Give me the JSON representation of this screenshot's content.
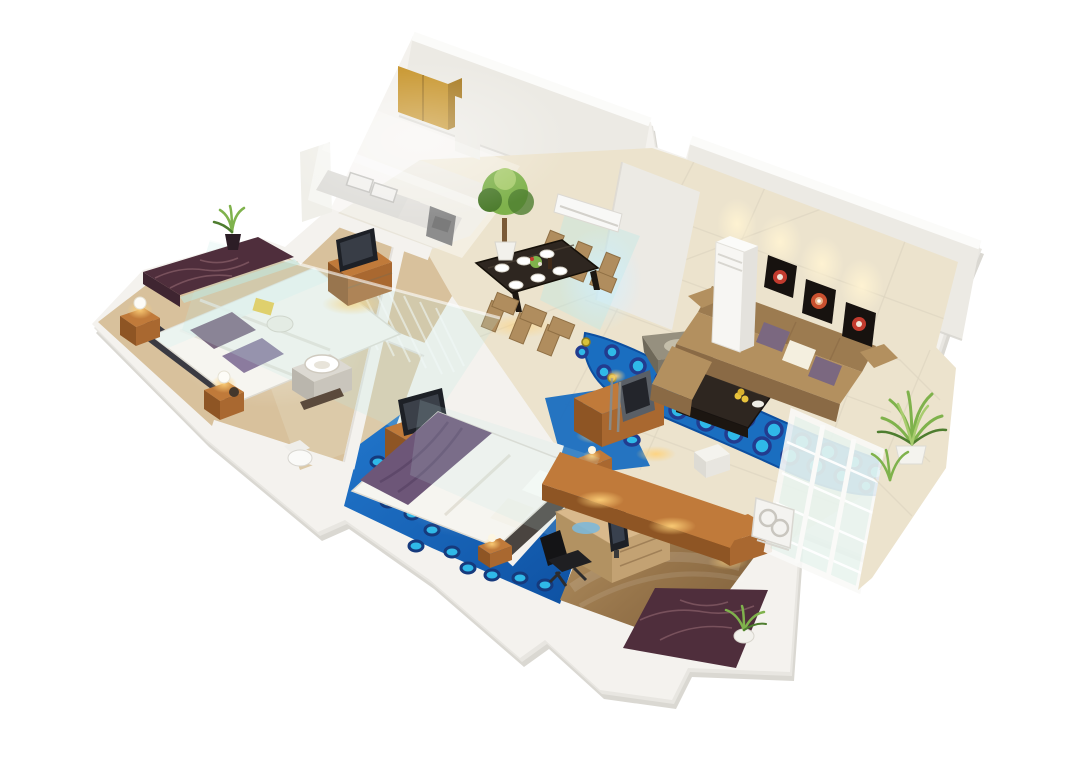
{
  "meta": {
    "title": "3D isometric apartment floor plan render",
    "style": "photoreal dollhouse cutaway, white background, no visible text"
  },
  "palette": {
    "bg": "#ffffff",
    "wall": "#f4f2ee",
    "wallFace": "#eceae4",
    "wallEdge": "#e0ded8",
    "wallShadow": "#d7d5cf",
    "floorCream": "#ece3cd",
    "floorTan": "#d8c19c",
    "floorBath": "#dccaa9",
    "floorStudy1": "#b3905f",
    "floorStudy2": "#7c5e3a",
    "mosaicBlue1": "#1a6ec0",
    "mosaicBlue2": "#0d4fa0",
    "dotFill": "#2fb9e8",
    "dotRing": "#223c8f",
    "wood": "#c07a3a",
    "woodSide": "#a96830",
    "woodFront": "#8e5524",
    "woodPale": "#d9b98c",
    "marble": "#4f2e3c",
    "marbleVein": "#9a6f77",
    "sofaSeat": "#b3905f",
    "sofaBack": "#9c7b50",
    "sofaFront": "#8a6a45",
    "pillowPurple": "#7b6880",
    "pillowCream": "#f4efdf",
    "ottomanTop": "#96907f",
    "ottomanSide": "#7c7668",
    "tableDark": "#2e2620",
    "chairTan": "#b08d5e",
    "artFrame": "#17120f",
    "artRed": "#c23b2e",
    "glass": "#bfe9e4",
    "plantMid": "#7fb24c",
    "plantDark": "#4e7d2f",
    "plantLight": "#a8cc6e",
    "lampWarm": "#ffc96b",
    "tvDark": "#1d2026",
    "bedWhite": "#f6f5f0",
    "blanketPurple": "#6d5678",
    "goldCabinet": "#c8962e",
    "goldCabinetSide": "#a87b22"
  },
  "scene": {
    "name": "Two-bedroom apartment, 3D cutaway view",
    "rooms": [
      {
        "name": "Master bedroom with balcony",
        "furniture": [
          "double bed with white duvet",
          "dark headboard",
          "purple throw pillows",
          "two wooden nightstands with ball lamps",
          "wooden TV cabinet with flat TV",
          "glass canopy panel",
          "marble balcony with potted plant",
          "yellow book and tray on bed"
        ]
      },
      {
        "name": "Kitchen",
        "furniture": [
          "golden wall cabinet",
          "water heater",
          "double sink counter",
          "oven",
          "tall fridge"
        ]
      },
      {
        "name": "Dining area",
        "furniture": [
          "dark dining table",
          "six tan chairs",
          "white place settings",
          "flower centerpiece",
          "potted tree"
        ]
      },
      {
        "name": "Entry hall",
        "furniture": [
          "wall-mounted split air conditioner",
          "teal light beam"
        ]
      },
      {
        "name": "Living room",
        "furniture": [
          "brown fabric sofa with purple and cream pillows",
          "gray ottoman",
          "dark coffee table with fruit bowl",
          "wooden media console with TV panel",
          "three black-and-red wall artworks with spotlights",
          "floor-standing AC tower",
          "blue mosaic ribbon floor inlay",
          "french doors"
        ]
      },
      {
        "name": "Bathroom",
        "furniture": [
          "round countertop basin on vanity",
          "toilet"
        ]
      },
      {
        "name": "Second bedroom",
        "furniture": [
          "bed with white duvet and purple blanket",
          "two nightstands with lamps",
          "wooden dresser with TV",
          "blue mosaic floor"
        ]
      },
      {
        "name": "Study",
        "furniture": [
          "light wood L-desk",
          "computer monitor",
          "black office chair",
          "wooden sideboard",
          "glossy wood floor"
        ]
      },
      {
        "name": "Right balcony",
        "furniture": [
          "white french-door wall",
          "palm plants in white planter",
          "outdoor AC unit",
          "cream tile floor"
        ]
      },
      {
        "name": "Rear balcony",
        "furniture": [
          "marble floor",
          "potted plant"
        ]
      }
    ]
  }
}
